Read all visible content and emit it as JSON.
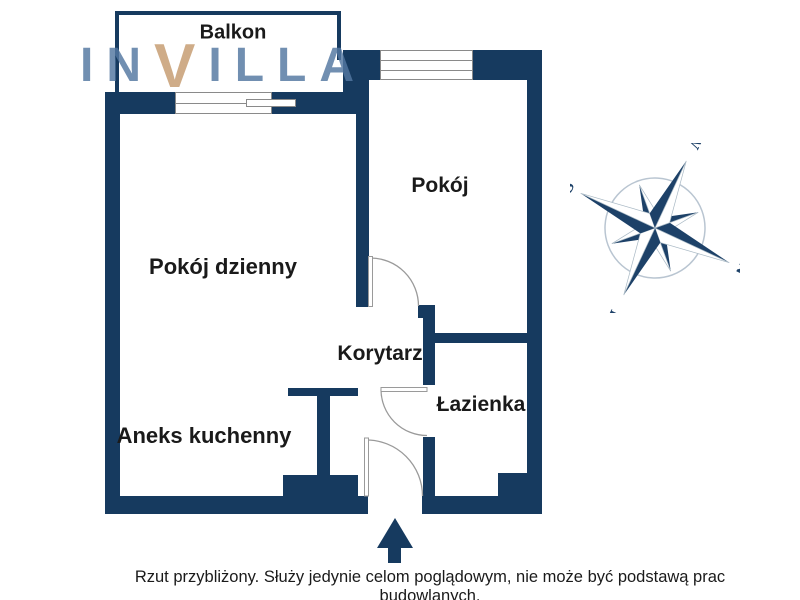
{
  "watermark": {
    "part1": "IN",
    "accent": "V",
    "part2": "ILLA"
  },
  "rooms": {
    "balkon": "Balkon",
    "pokoj": "Pokój",
    "pokoj_dzienny": "Pokój dzienny",
    "korytarz": "Korytarz",
    "lazienka": "Łazienka",
    "aneks_kuchenny": "Aneks kuchenny"
  },
  "compass": {
    "north": "N",
    "east": "E",
    "south": "S",
    "west": "W"
  },
  "disclaimer": "Rzut przybliżony. Służy jedynie celom poglądowym, nie może być podstawą prac budowlanych.",
  "colors": {
    "wall": "#163a5f",
    "logo_blue": "#5377a1",
    "logo_accent": "#c59b6e",
    "door_arc": "#9a9a9a",
    "window_frame": "#8a8a8a",
    "compass_navy": "#1d4168",
    "compass_ring": "#b9c5d1",
    "text": "#1a1a1a"
  }
}
